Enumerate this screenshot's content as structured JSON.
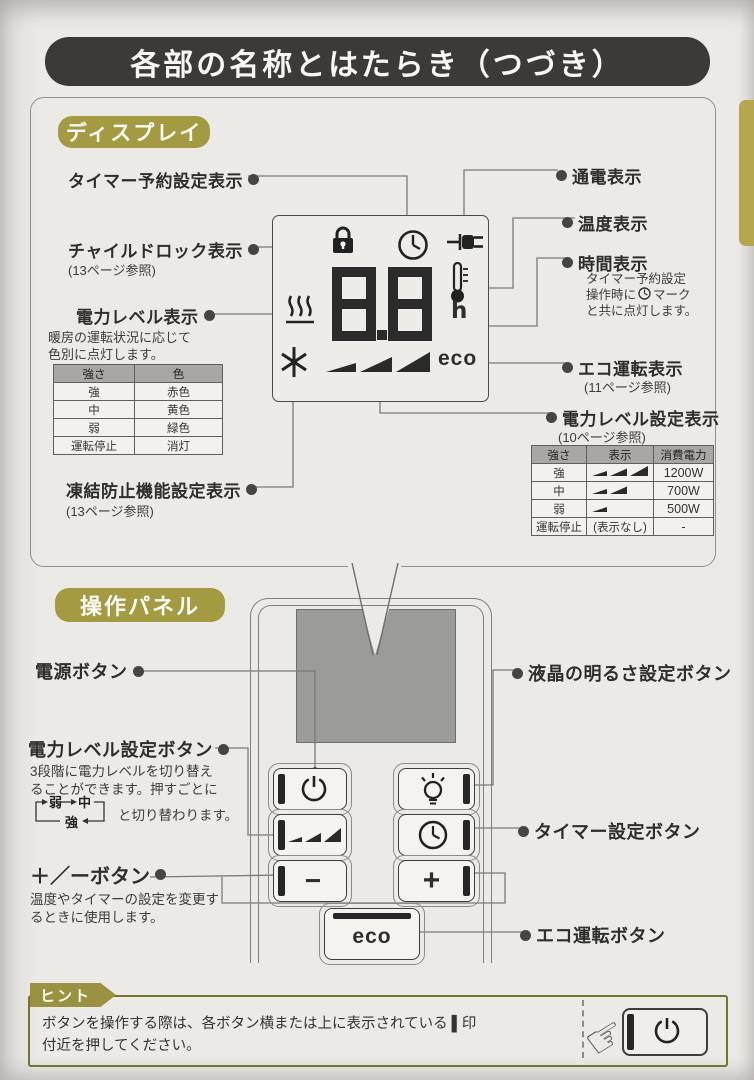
{
  "page": {
    "title": "各部の名称とはたらき（つづき）"
  },
  "display_section": {
    "badge": "ディスプレイ",
    "labels_left": {
      "timer_reserve": "タイマー予約設定表示",
      "child_lock": "チャイルドロック表示",
      "child_lock_ref": "(13ページ参照)",
      "power_level": "電力レベル表示",
      "power_level_desc1": "暖房の運転状況に応じて",
      "power_level_desc2": "色別に点灯します。",
      "freeze": "凍結防止機能設定表示",
      "freeze_ref": "(13ページ参照)"
    },
    "labels_right": {
      "power_on": "通電表示",
      "temperature": "温度表示",
      "time": "時間表示",
      "time_desc1": "タイマー予約設定",
      "time_desc2a": "操作時に",
      "time_desc2b": "マーク",
      "time_desc3": "と共に点灯します。",
      "eco": "エコ運転表示",
      "eco_ref": "(11ページ参照)",
      "level_setting": "電力レベル設定表示",
      "level_setting_ref": "(10ページ参照)"
    },
    "display_unit": {
      "digits": "8.8",
      "hour": "h",
      "eco": "eco"
    },
    "color_table": {
      "headers": [
        "強さ",
        "色"
      ],
      "rows": [
        [
          "強",
          "赤色"
        ],
        [
          "中",
          "黄色"
        ],
        [
          "弱",
          "緑色"
        ],
        [
          "運転停止",
          "消灯"
        ]
      ]
    },
    "power_table": {
      "headers": [
        "強さ",
        "表示",
        "消費電力"
      ],
      "rows": [
        {
          "level": "強",
          "bars": 3,
          "watt": "1200W"
        },
        {
          "level": "中",
          "bars": 2,
          "watt": "700W"
        },
        {
          "level": "弱",
          "bars": 1,
          "watt": "500W"
        },
        {
          "level": "運転停止",
          "bars": 0,
          "bars_text": "(表示なし)",
          "watt": "-"
        }
      ]
    }
  },
  "panel_section": {
    "badge": "操作パネル",
    "labels_left": {
      "power_btn": "電源ボタン",
      "level_btn": "電力レベル設定ボタン",
      "level_desc1": "3段階に電力レベルを切り替え",
      "level_desc2": "ることができます。押すごとに",
      "cycle_weak": "弱",
      "cycle_mid": "中",
      "cycle_strong": "強",
      "level_desc3": "と切り替わります。",
      "plusminus_btn": "＋／ーボタン",
      "plusminus_desc1": "温度やタイマーの設定を変更す",
      "plusminus_desc2": "るときに使用します。"
    },
    "labels_right": {
      "brightness_btn": "液晶の明るさ設定ボタン",
      "timer_btn": "タイマー設定ボタン",
      "eco_btn": "エコ運転ボタン"
    },
    "buttons": {
      "minus": "−",
      "plus": "+",
      "eco": "eco"
    }
  },
  "hint": {
    "badge": "ヒント",
    "line1": "ボタンを操作する際は、各ボタン横または上に表示されている ▌印",
    "line2": "付近を押してください。"
  }
}
